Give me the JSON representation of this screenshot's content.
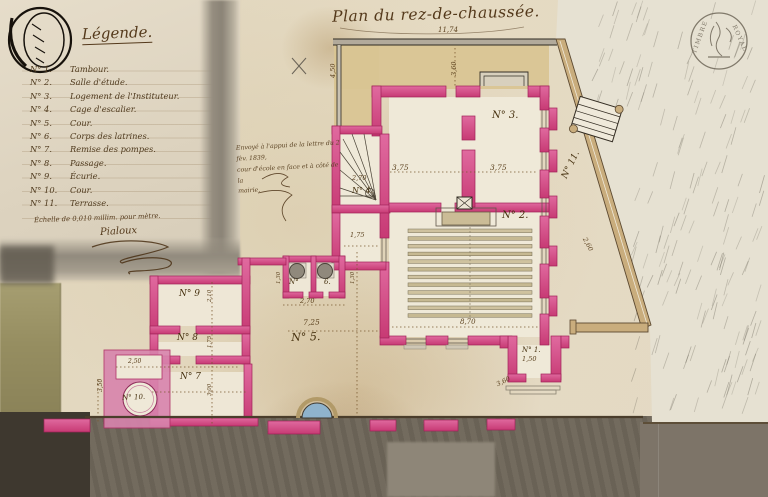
{
  "title": "Plan du rez-de-chaussée.",
  "legend": {
    "title": "Légende.",
    "entries": [
      {
        "num": "N° 1.",
        "label": "Tambour."
      },
      {
        "num": "N° 2.",
        "label": "Salle d'étude."
      },
      {
        "num": "N° 3.",
        "label": "Logement de l'Instituteur."
      },
      {
        "num": "N° 4.",
        "label": "Cage d'escalier."
      },
      {
        "num": "N° 5.",
        "label": "Cour."
      },
      {
        "num": "N° 6.",
        "label": "Corps des latrines."
      },
      {
        "num": "N° 7.",
        "label": "Remise des pompes."
      },
      {
        "num": "N° 8.",
        "label": "Passage."
      },
      {
        "num": "N° 9.",
        "label": "Écurie."
      },
      {
        "num": "N° 10.",
        "label": "Cour."
      },
      {
        "num": "N° 11.",
        "label": "Terrasse."
      }
    ],
    "scale_note": "Échelle de 0,010 millim. pour mètre.",
    "signature": "Pialoux"
  },
  "note": {
    "lines": [
      "Envoyé à l'appui de la lettre du 2 fèv. 1839,",
      "cour d'école en face et à côté de la",
      "mairie."
    ]
  },
  "stamp": {
    "word_left": "TIMBRE",
    "word_right": "ROYAL"
  },
  "plan": {
    "room_labels": [
      {
        "text": "N° 3.",
        "x": 492,
        "y": 110,
        "size": 10,
        "rot": 0
      },
      {
        "text": "N° 4.",
        "x": 352,
        "y": 186,
        "size": 8,
        "rot": 0
      },
      {
        "text": "N° 2.",
        "x": 502,
        "y": 210,
        "size": 10,
        "rot": 0
      },
      {
        "text": "N° 1.",
        "x": 522,
        "y": 346,
        "size": 7,
        "rot": 0
      },
      {
        "text": "N° 5.",
        "x": 291,
        "y": 331,
        "size": 11,
        "rot": -2
      },
      {
        "text": "N°",
        "x": 289,
        "y": 278,
        "size": 7,
        "rot": 0
      },
      {
        "text": "6.",
        "x": 324,
        "y": 278,
        "size": 7,
        "rot": 0
      },
      {
        "text": "N° 7",
        "x": 180,
        "y": 372,
        "size": 9,
        "rot": 0
      },
      {
        "text": "N° 8",
        "x": 177,
        "y": 333,
        "size": 9,
        "rot": 0
      },
      {
        "text": "N° 9",
        "x": 179,
        "y": 289,
        "size": 9,
        "rot": 0
      },
      {
        "text": "N° 10.",
        "x": 122,
        "y": 394,
        "size": 7,
        "rot": -3
      },
      {
        "text": "N° 11.",
        "x": 560,
        "y": 176,
        "size": 9,
        "rot": -64
      }
    ],
    "dimension_labels": [
      {
        "text": "11,74",
        "x": 438,
        "y": 26,
        "size": 7,
        "rot": 0
      },
      {
        "text": "4,50",
        "x": 329,
        "y": 78,
        "size": 6.5,
        "rot": -90
      },
      {
        "text": "3,60",
        "x": 450,
        "y": 76,
        "size": 6.5,
        "rot": -90
      },
      {
        "text": "3,75",
        "x": 392,
        "y": 163,
        "size": 7.5,
        "rot": 0
      },
      {
        "text": "3,75",
        "x": 490,
        "y": 163,
        "size": 7.5,
        "rot": 0
      },
      {
        "text": "2,70",
        "x": 352,
        "y": 174,
        "size": 6.5,
        "rot": 0
      },
      {
        "text": "1,75",
        "x": 350,
        "y": 231,
        "size": 6.5,
        "rot": 0
      },
      {
        "text": "8,70",
        "x": 460,
        "y": 318,
        "size": 7,
        "rot": 0
      },
      {
        "text": "1,50",
        "x": 522,
        "y": 355,
        "size": 6.5,
        "rot": 0
      },
      {
        "text": "3,60",
        "x": 495,
        "y": 381,
        "size": 6.5,
        "rot": -26
      },
      {
        "text": "2,60",
        "x": 588,
        "y": 236,
        "size": 6.5,
        "rot": 62
      },
      {
        "text": "7,25",
        "x": 303,
        "y": 318,
        "size": 7.5,
        "rot": -2
      },
      {
        "text": "2,70",
        "x": 300,
        "y": 297,
        "size": 6.5,
        "rot": 0
      },
      {
        "text": "1,30",
        "x": 276,
        "y": 284,
        "size": 5.5,
        "rot": -90
      },
      {
        "text": "1,30",
        "x": 350,
        "y": 284,
        "size": 5.5,
        "rot": -90
      },
      {
        "text": "2,50",
        "x": 128,
        "y": 358,
        "size": 6,
        "rot": 0
      },
      {
        "text": "3,50",
        "x": 97,
        "y": 392,
        "size": 6,
        "rot": -90
      },
      {
        "text": "2,10",
        "x": 207,
        "y": 302,
        "size": 5.5,
        "rot": -90
      },
      {
        "text": "1,75",
        "x": 207,
        "y": 348,
        "size": 5.5,
        "rot": -90
      },
      {
        "text": "3,00",
        "x": 207,
        "y": 396,
        "size": 5.5,
        "rot": -90
      }
    ]
  },
  "colors": {
    "wall_pink": "#d9558c",
    "wall_pink_deep": "#a82460",
    "ink_brown": "#54391b",
    "terrace_tan": "#c9ad7d",
    "street_gray": "#6f675a",
    "well_blue": "#8fb3cc"
  }
}
